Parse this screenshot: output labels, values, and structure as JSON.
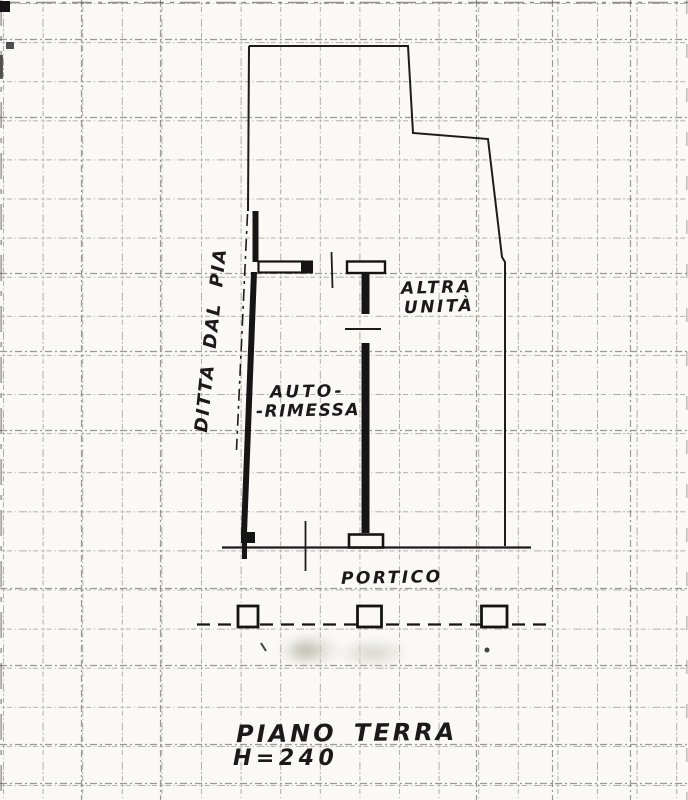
{
  "plan": {
    "boundary_label": "DITTA DAL PIA",
    "rooms": {
      "altra_unita": {
        "line1": "ALTRA",
        "line2": "UNITÀ"
      },
      "autorimessa": {
        "line1": "AUTO-",
        "line2": "-RIMESSA"
      },
      "portico": "PORTICO"
    },
    "title": {
      "line1": "PIANO TERRA",
      "line2": "H=240"
    }
  },
  "colors": {
    "paper": "#faf9f6",
    "ink": "#1c1c1c",
    "grid": "#45443f"
  }
}
